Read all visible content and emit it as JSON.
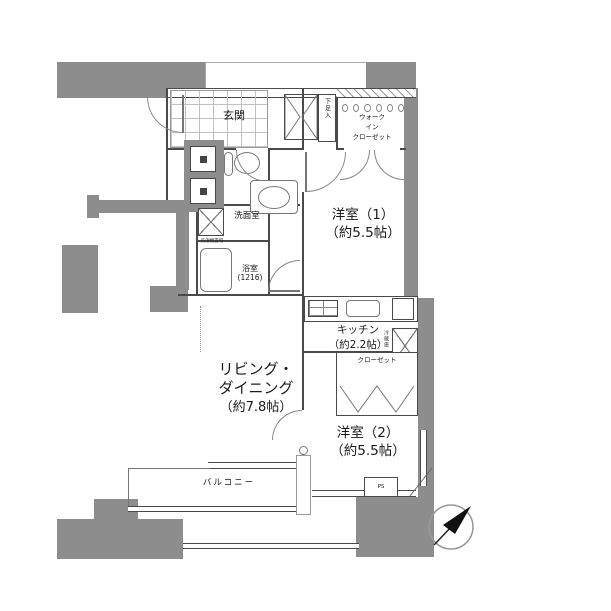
{
  "colors": {
    "wall": "#8d8d8d",
    "line": "#4a4a4a",
    "door_arc": "#888888",
    "background": "#ffffff"
  },
  "rooms": {
    "entrance": {
      "label": "玄関"
    },
    "shoe_cabinet": {
      "label": "下足入"
    },
    "wic": {
      "line1": "ウォーク",
      "line2": "イン",
      "line3": "クローゼット"
    },
    "western1": {
      "name": "洋室（1）",
      "area": "（約5.5帖）"
    },
    "washroom": {
      "label": "洗面室",
      "washer": "洗濯機置場"
    },
    "bathroom": {
      "label": "浴室",
      "size": "(1216)"
    },
    "kitchen": {
      "name": "キッチン",
      "area": "（約2.2帖）",
      "fridge": "冷蔵庫"
    },
    "closet": {
      "label": "クローゼット"
    },
    "western2": {
      "name": "洋室（2）",
      "area": "（約5.5帖）"
    },
    "living": {
      "name1": "リビング・",
      "name2": "ダイニング",
      "area": "（約7.8帖）"
    },
    "balcony": {
      "label": "バルコニー"
    },
    "pipe_space": {
      "label": "PS"
    }
  },
  "compass": {
    "direction": "northeast"
  }
}
